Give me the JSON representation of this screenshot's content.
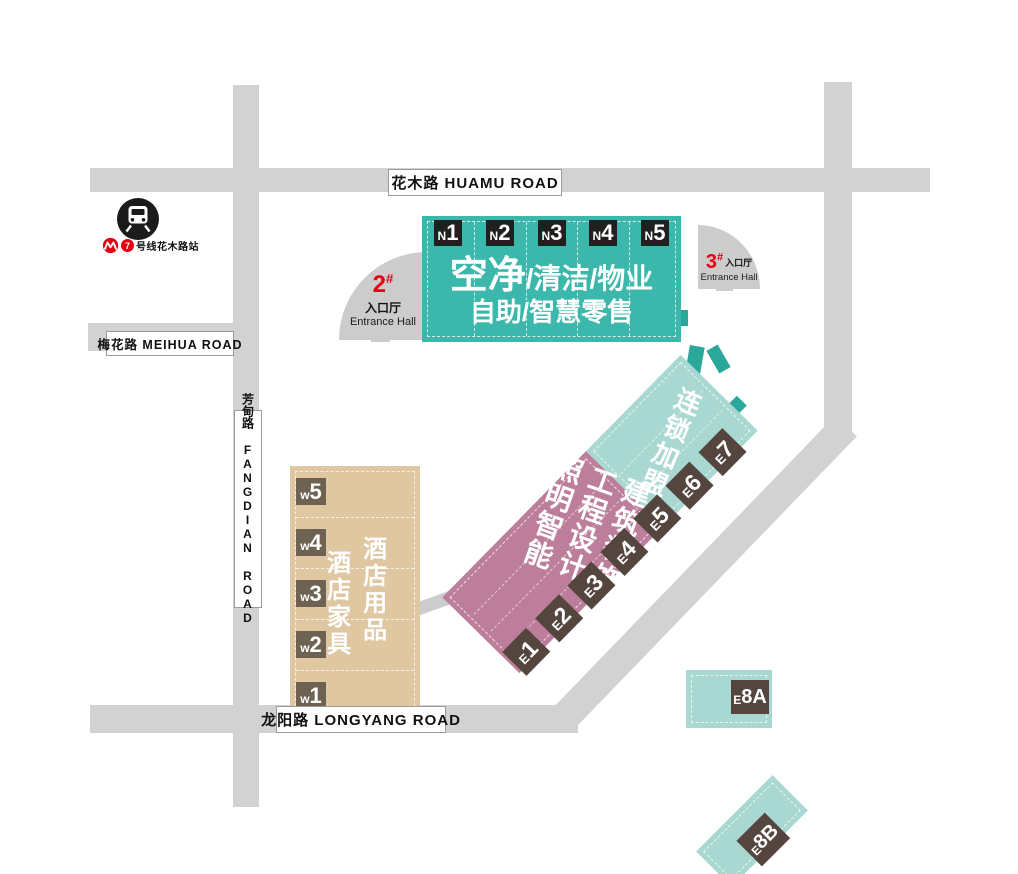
{
  "roads": {
    "huamu": "花木路 HUAMU ROAD",
    "meihua": "梅花路 MEIHUA ROAD",
    "fangdian": "芳甸路 FANGDIAN ROAD",
    "longyang": "龙阳路 LONGYANG ROAD"
  },
  "metro": {
    "line": "7",
    "station": "号线花木路站"
  },
  "entrances": {
    "e1": {
      "num": "1",
      "hash": "#",
      "hall_zh": "入口厅",
      "hall_en": "Entrance Hall"
    },
    "e2": {
      "num": "2",
      "hash": "#",
      "hall_zh": "入口厅",
      "hall_en": "Entrance Hall"
    },
    "e3": {
      "num": "3",
      "hash": "#",
      "hall_zh": "入口厅",
      "hall_en": "Entrance Hall"
    }
  },
  "halls": {
    "north": {
      "label_big": "空净",
      "label_line1_rest": "/清洁/物业",
      "label_line2": "自助/智慧零售",
      "badges": [
        {
          "p": "N",
          "n": "1"
        },
        {
          "p": "N",
          "n": "2"
        },
        {
          "p": "N",
          "n": "3"
        },
        {
          "p": "N",
          "n": "4"
        },
        {
          "p": "N",
          "n": "5"
        }
      ]
    },
    "west": {
      "col_right": "酒店用品",
      "col_left": "酒店家具",
      "badges": [
        {
          "p": "w",
          "n": "5"
        },
        {
          "p": "w",
          "n": "4"
        },
        {
          "p": "w",
          "n": "3"
        },
        {
          "p": "w",
          "n": "2"
        },
        {
          "p": "w",
          "n": "1"
        }
      ]
    },
    "east": {
      "teal_label": "连锁加盟",
      "pink_cols": [
        "建筑装饰",
        "工程设计",
        "照明智能"
      ],
      "badges": [
        {
          "p": "E",
          "n": "1"
        },
        {
          "p": "E",
          "n": "2"
        },
        {
          "p": "E",
          "n": "3"
        },
        {
          "p": "E",
          "n": "4"
        },
        {
          "p": "E",
          "n": "5"
        },
        {
          "p": "E",
          "n": "6"
        },
        {
          "p": "E",
          "n": "7"
        }
      ],
      "e8a": {
        "p": "E",
        "n": "8A"
      },
      "e8b": {
        "p": "E",
        "n": "8B"
      }
    }
  },
  "colors": {
    "teal": "#3bb8ab",
    "teal-light": "#a9d8d2",
    "teal-dark": "#2ba89a",
    "pink": "#bc7e9b",
    "tan": "#dfc7a2",
    "road": "#d2d2d2",
    "fan": "#cccccc",
    "badge-dark": "#20201e",
    "badge-brown": "#6e6253",
    "badge-e": "#54463e",
    "red": "#e60012"
  }
}
